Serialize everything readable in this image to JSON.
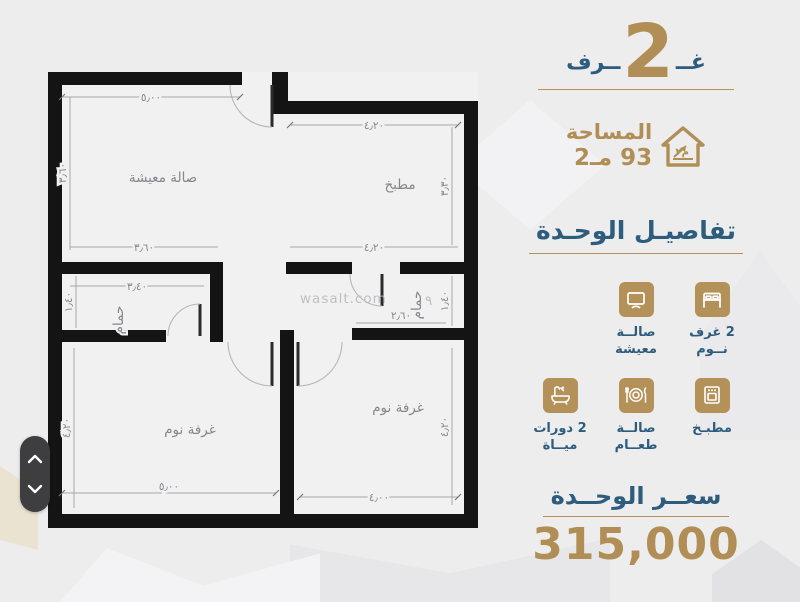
{
  "colors": {
    "gold": "#b18e55",
    "blue": "#2e5c7c",
    "background": "#ededee",
    "wall": "#141414",
    "pill": "#3e3e41"
  },
  "icons": {
    "area": "house-area-icon",
    "bedrooms": "bed-icon",
    "living": "tv-icon",
    "kitchen": "oven-icon",
    "dining": "dining-plate-icon",
    "bathrooms": "bathtub-icon",
    "scroll_up": "chevron-up-icon",
    "scroll_down": "chevron-down-icon"
  },
  "header": {
    "rooms_word_right": "غــ",
    "rooms_number": "2",
    "rooms_word_left": "ــرف",
    "area_label": "المساحة",
    "area_value": "93 مـ2"
  },
  "details": {
    "title": "تفاصيـل الوحـدة",
    "items": [
      {
        "icon": "bed-icon",
        "line1": "2 غرف",
        "line2": "نــوم"
      },
      {
        "icon": "tv-icon",
        "line1": "صالــة",
        "line2": "معيشة"
      },
      {
        "icon": "oven-icon",
        "line1": "مطبـخ",
        "line2": ""
      },
      {
        "icon": "dining-plate-icon",
        "line1": "صالــة",
        "line2": "طعــام"
      },
      {
        "icon": "bathtub-icon",
        "line1": "2 دورات",
        "line2": "ميــاة"
      }
    ]
  },
  "price": {
    "title": "سعــر الوحــدة",
    "value": "315,000"
  },
  "floorplan": {
    "watermark": "wasalt.com",
    "watermark_mark": "٩",
    "room_labels": {
      "living": "صالة معيشة",
      "kitchen": "مطبخ",
      "bath1": "حمام",
      "bath2": "حمام",
      "bedroom1": "غرفة نوم",
      "bedroom2": "غرفة نوم"
    },
    "dims": {
      "living_top": "٥٫٠٠",
      "living_left": "٣٫٦٠",
      "living_bottom": "٣٫٦٠",
      "kitchen_top": "٤٫٢٠",
      "kitchen_bottom": "٤٫٢٠",
      "kitchen_right": "٣٫٣٠",
      "bath1_top": "٣٫٤٠",
      "bath1_left": "١٫٤٠",
      "bath2_bottom": "٢٫٦٠",
      "bath2_right": "١٫٤٠",
      "bedroom1_left": "٤٫٢٠",
      "bedroom1_bottom": "٥٫٠٠",
      "bedroom2_bottom": "٤٫٠٠",
      "bedroom2_right": "٤٫٢٠"
    }
  }
}
